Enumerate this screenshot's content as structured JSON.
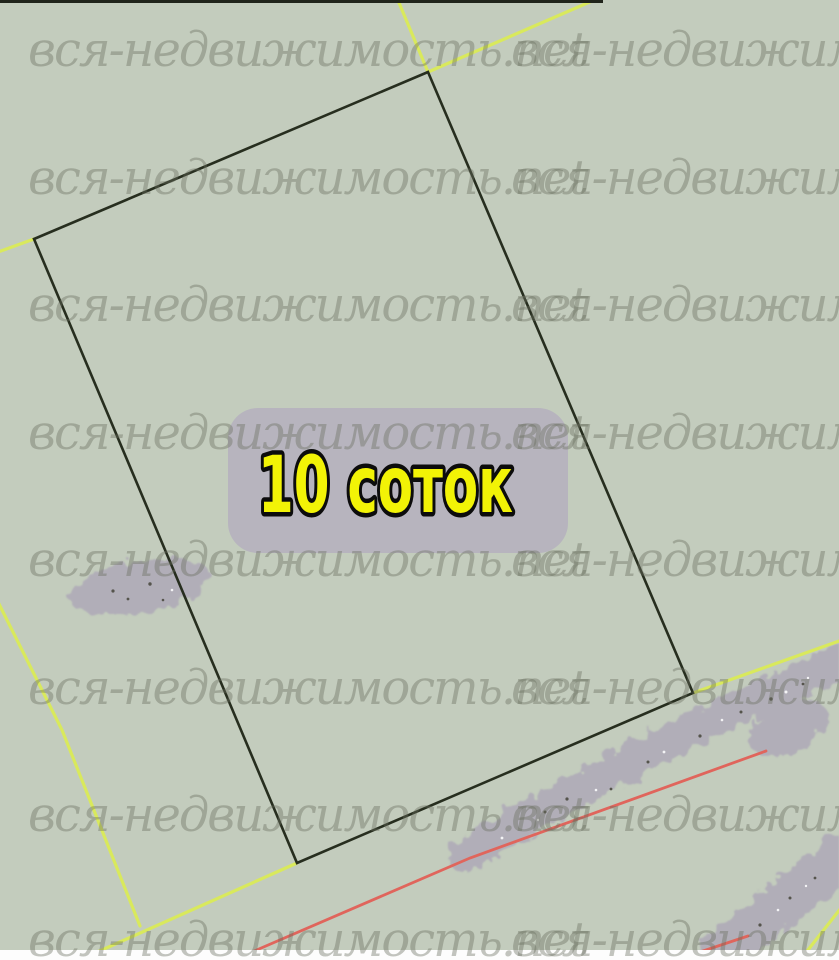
{
  "map": {
    "area_label": "10 соток",
    "watermark_text": "вся-недвижимость.net",
    "colors": {
      "background": "#c3ccbd",
      "plot_boundary": "#272e1f",
      "cadastral_line": "#d9e95c",
      "road_line": "#e0655c",
      "terrain_blob": "#b1aeb8",
      "label_panel": "#b6b3bd",
      "label_text": "#f2f306",
      "label_text_outline": "#0c0c0c",
      "speckle_dark": "#55544c",
      "speckle_light": "#f4f4f6",
      "watermark": "#68705f",
      "bottom_strip": "#fdfdfd",
      "top_strip": "#20241b"
    }
  }
}
